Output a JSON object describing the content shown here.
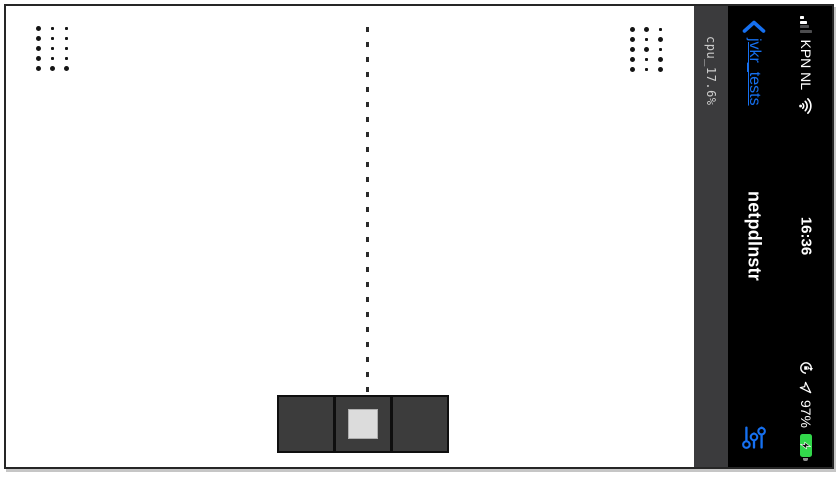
{
  "app": {
    "title": "netpdlnstr",
    "back_link": "jvkr_tests"
  },
  "overlay": {
    "cpu_label": "cpu_17.6%"
  },
  "status_bar": {
    "carrier": "KPN NL",
    "time": "16:36",
    "battery_percent": "97%",
    "battery_charging": true,
    "signal": {
      "bars_total": 4,
      "bars_filled": 2
    },
    "icons": [
      "cellular-signal",
      "wifi",
      "orientation-lock",
      "location-arrow",
      "battery-charging"
    ]
  },
  "nav_bar": {
    "icons": [
      "back-chevron",
      "sliders"
    ]
  },
  "game": {
    "left_dot_grid": [
      [
        1,
        0,
        0
      ],
      [
        1,
        0,
        0
      ],
      [
        1,
        0,
        0
      ],
      [
        1,
        0,
        0
      ],
      [
        1,
        1,
        1
      ]
    ],
    "right_dot_grid": [
      [
        1,
        1,
        0
      ],
      [
        1,
        0,
        1
      ],
      [
        1,
        1,
        0
      ],
      [
        1,
        0,
        1
      ],
      [
        1,
        0,
        1
      ]
    ],
    "center_line": "vertical-dashed",
    "paddle_segments": 3,
    "ball_in_center_segment": true
  },
  "colors": {
    "accent_blue": "#1670f0",
    "battery_green": "#32d74b",
    "panel_black": "#000000",
    "cpu_strip_gray": "#3b3b3d",
    "paddle_gray": "#3c3c3c",
    "ball_gray": "#dcdcdc"
  }
}
